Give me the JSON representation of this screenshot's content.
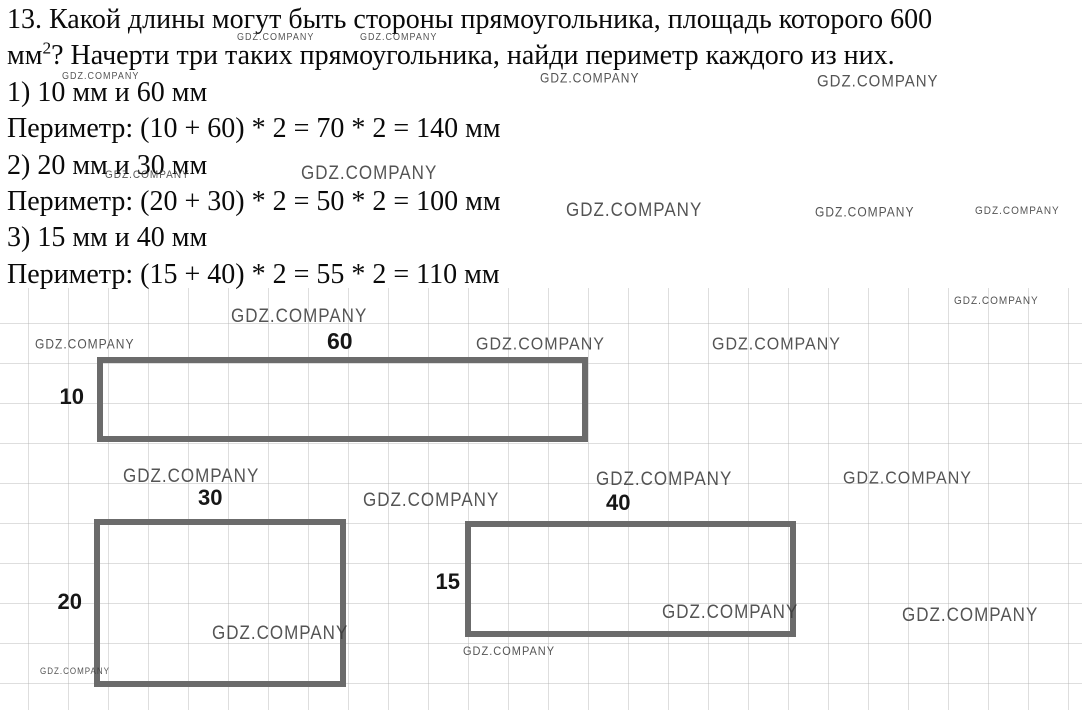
{
  "problem": {
    "line1": "13. Какой длины могут быть стороны прямоугольника, площадь которого 600",
    "line2_prefix": "мм",
    "line2_sup": "2",
    "line2_suffix": "? Начерти три таких прямоугольника, найди периметр каждого из них."
  },
  "solutions": [
    {
      "sides": "1) 10 мм и 60 мм",
      "perimeter": "Периметр: (10 + 60) * 2 = 70 * 2 = 140 мм"
    },
    {
      "sides": "2) 20 мм и 30 мм",
      "perimeter": "Периметр: (20 + 30) * 2 = 50 * 2 = 100 мм"
    },
    {
      "sides": "3) 15 мм и 40 мм",
      "perimeter": "Периметр: (15 + 40) * 2 = 55 * 2 = 110 мм"
    }
  ],
  "figures": [
    {
      "top_label": "60",
      "side_label": "10"
    },
    {
      "top_label": "30",
      "side_label": "20"
    },
    {
      "top_label": "40",
      "side_label": "15"
    }
  ],
  "watermark": {
    "text": "GDZ.COMPANY"
  },
  "colors": {
    "text": "#0a0a0a",
    "rect_border": "#6b6b6b",
    "watermark": "#3d3d3d",
    "grid_line": "#a8a8a8"
  }
}
